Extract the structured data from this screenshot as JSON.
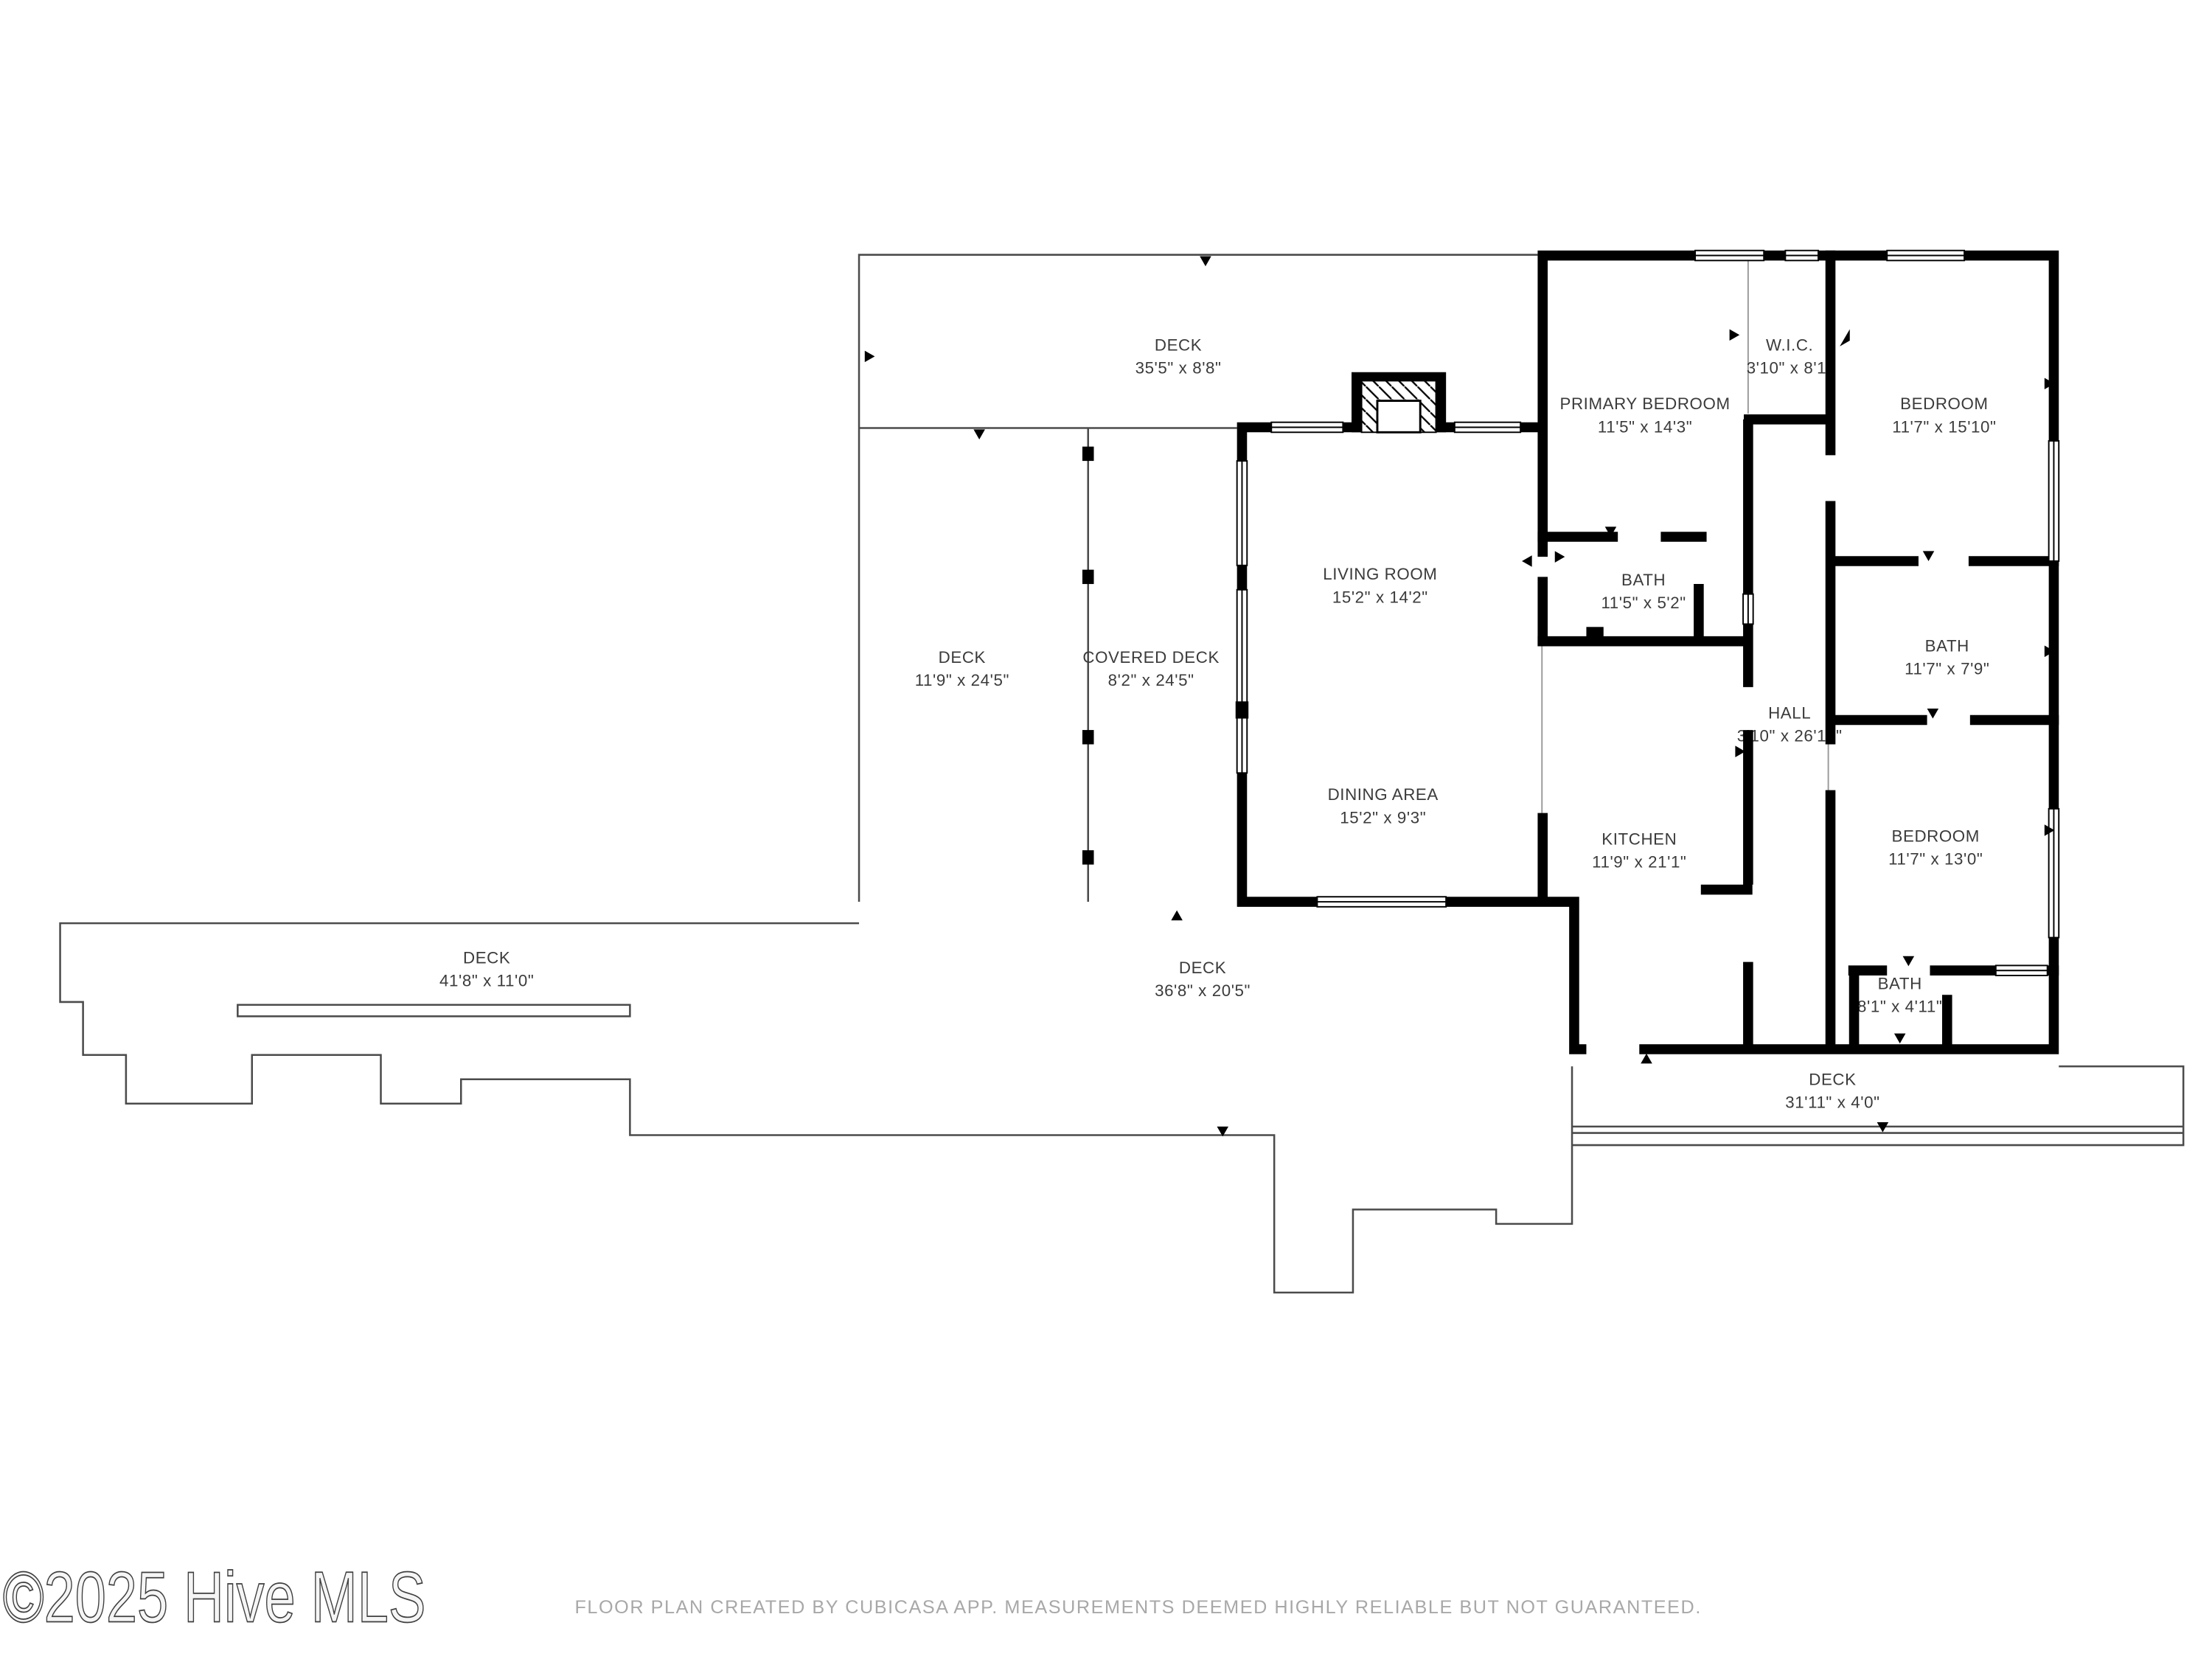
{
  "watermark": {
    "text": "©2025 Hive MLS"
  },
  "footer": {
    "disclaimer": "FLOOR PLAN CREATED BY CUBICASA APP. MEASUREMENTS DEEMED HIGHLY RELIABLE BUT NOT GUARANTEED."
  },
  "colors": {
    "wall": "#000000",
    "deck_line": "#4b4b4b",
    "label_text": "#3b3b3b",
    "footer_text": "#a8a8a8",
    "background": "#ffffff"
  },
  "rooms": [
    {
      "name": "DECK",
      "dims": "35'5\" x 8'8\""
    },
    {
      "name": "PRIMARY BEDROOM",
      "dims": "11'5\" x 14'3\""
    },
    {
      "name": "W.I.C.",
      "dims": "3'10\" x 8'1\""
    },
    {
      "name": "BEDROOM",
      "dims": "11'7\" x 15'10\""
    },
    {
      "name": "LIVING ROOM",
      "dims": "15'2\" x 14'2\""
    },
    {
      "name": "BATH",
      "dims": "11'5\" x 5'2\""
    },
    {
      "name": "DECK",
      "dims": "11'9\" x 24'5\""
    },
    {
      "name": "COVERED DECK",
      "dims": "8'2\" x 24'5\""
    },
    {
      "name": "BATH",
      "dims": "11'7\" x 7'9\""
    },
    {
      "name": "HALL",
      "dims": "3'10\" x 26'10\""
    },
    {
      "name": "DINING AREA",
      "dims": "15'2\" x 9'3\""
    },
    {
      "name": "KITCHEN",
      "dims": "11'9\" x 21'1\""
    },
    {
      "name": "BEDROOM",
      "dims": "11'7\" x 13'0\""
    },
    {
      "name": "DECK",
      "dims": "41'8\" x 11'0\""
    },
    {
      "name": "DECK",
      "dims": "36'8\" x 20'5\""
    },
    {
      "name": "BATH",
      "dims": "8'1\" x 4'11\""
    },
    {
      "name": "DECK",
      "dims": "31'11\" x 4'0\""
    }
  ]
}
